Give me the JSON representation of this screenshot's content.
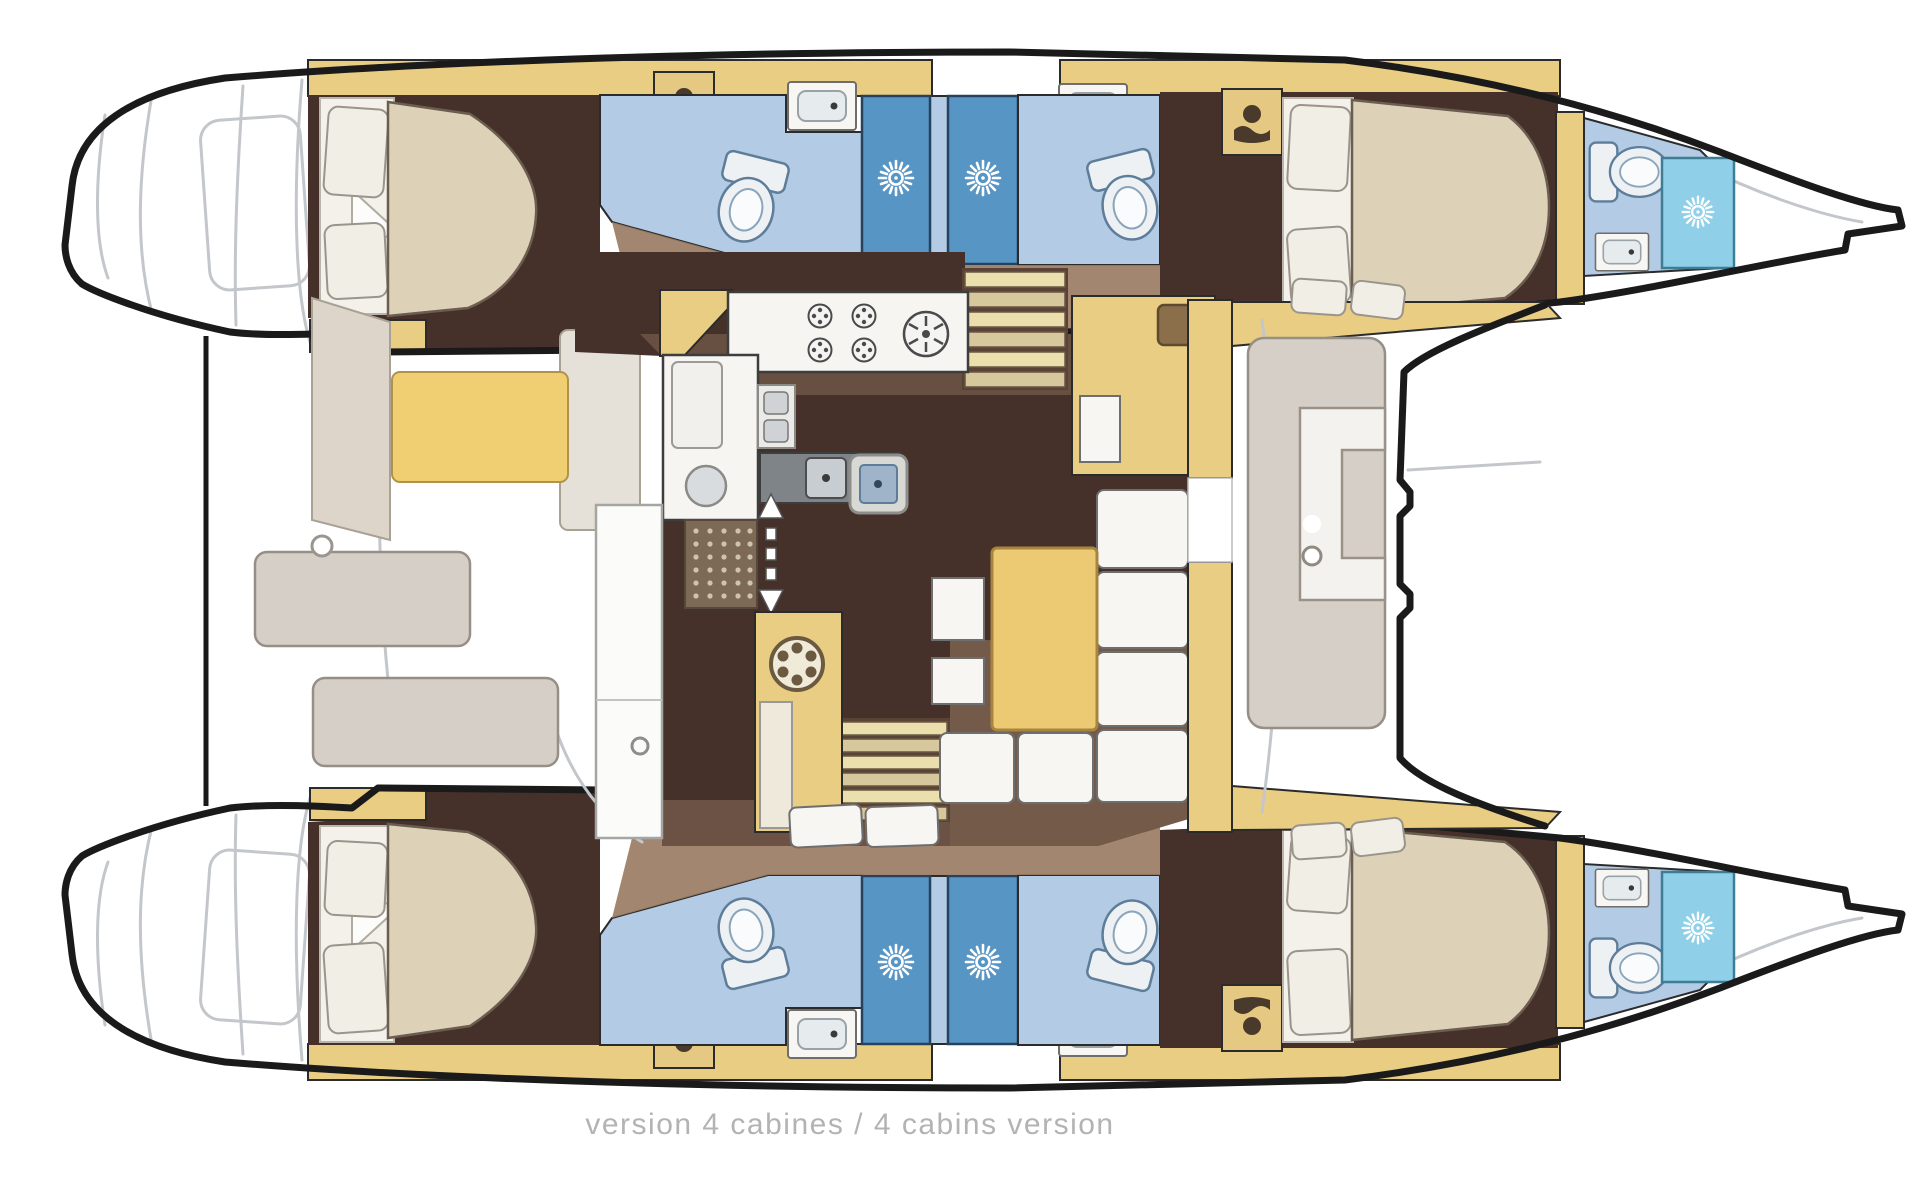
{
  "diagram": {
    "type": "catamaran-floor-plan",
    "caption": "version 4 cabines / 4 cabins version",
    "cabin_count": 4
  },
  "palette": {
    "outline": "#1a1a1a",
    "wall": "#2b2b2b",
    "deck-line": "#c3c7cb",
    "hull-fill": "#ffffff",
    "floor-dark": "#45312a",
    "floor-tan": "#9b7c63",
    "furniture-yellow": "#e9cd83",
    "cushion-yellow": "#f0cf72",
    "mattress": "#ddd1b8",
    "pillow": "#f1eee6",
    "bath-floor": "#b3cbe4",
    "shower-blue": "#5795c5",
    "shower-cyan": "#8fd0e8",
    "fixture": "#eef1f3",
    "bench-gray": "#d5cfc8",
    "caption-gray": "#b3b3b3"
  }
}
